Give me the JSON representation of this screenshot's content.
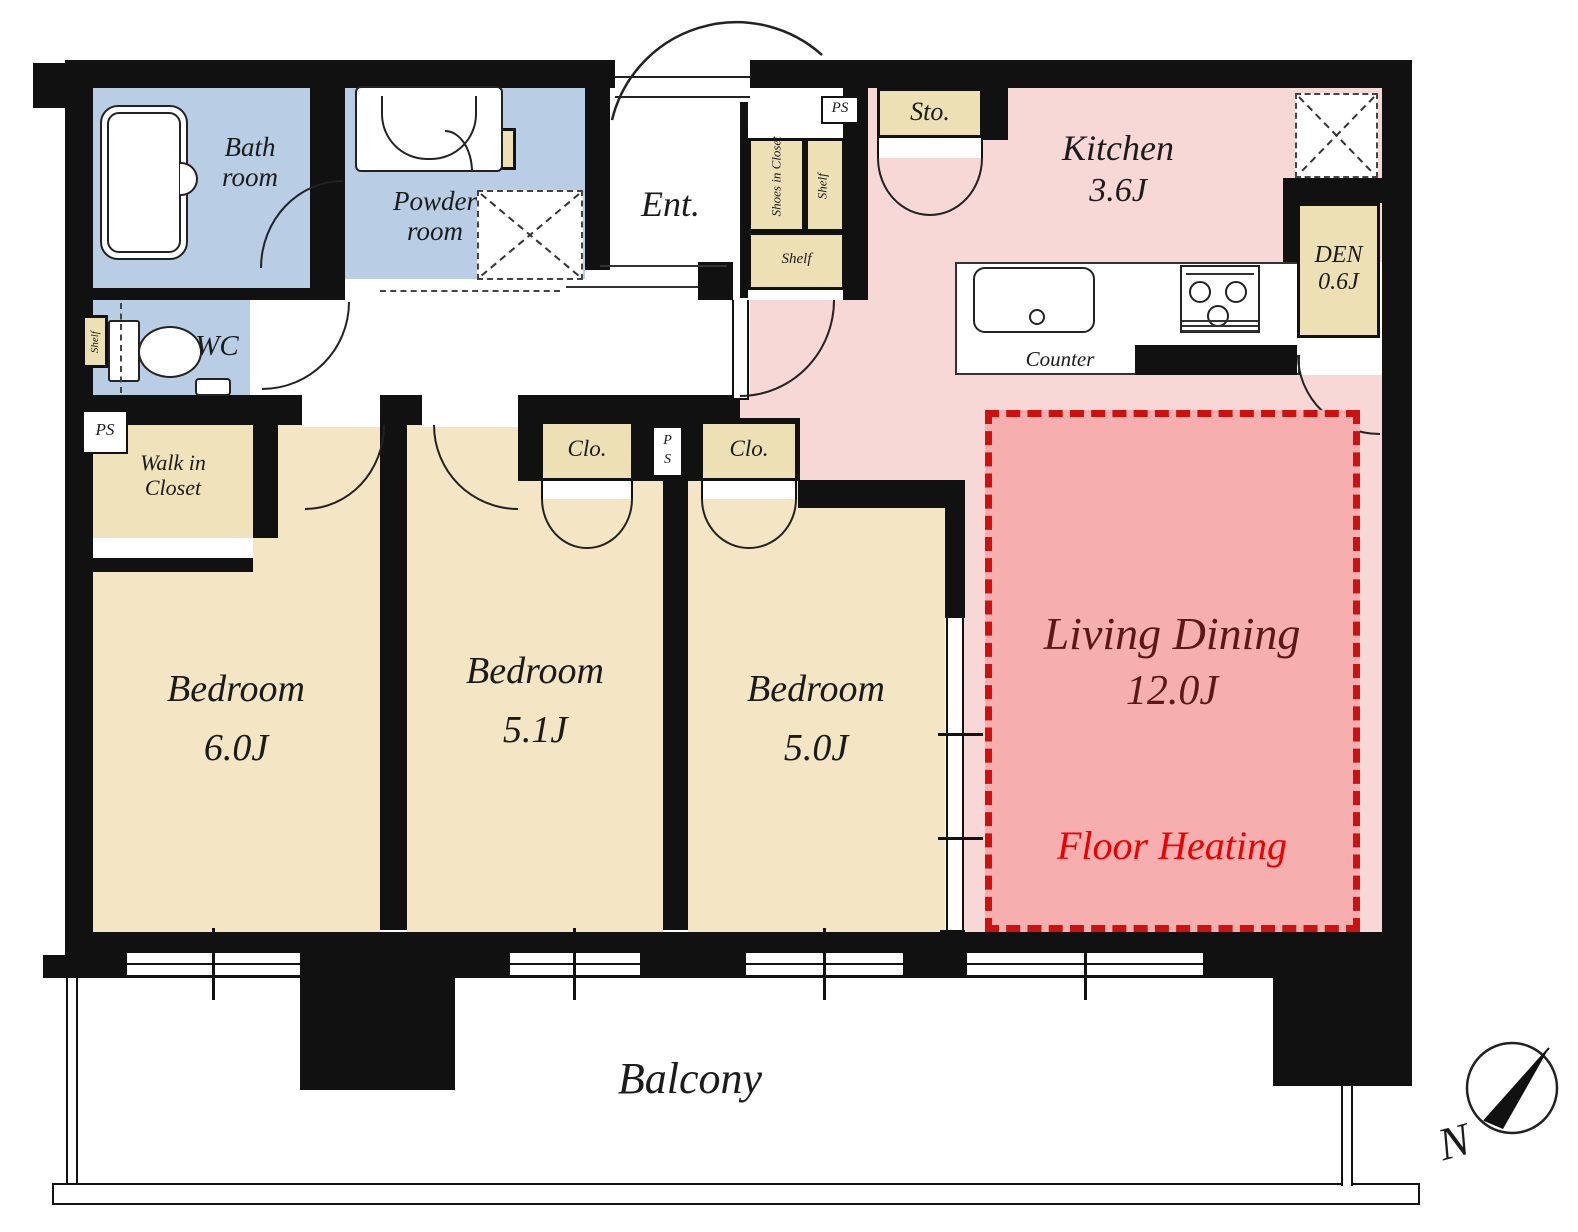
{
  "colors": {
    "wall": "#111111",
    "wet_area_blue": "#b9cde4",
    "room_beige": "#f4e6c4",
    "closet_beige": "#eee0b5",
    "kitchen_pink": "#f8d7d7",
    "floor_heating_pink": "#f6aeae",
    "floor_heating_dash_red": "#cc1111",
    "living_dining_text": "#5a1818",
    "floor_heating_text": "#ee0000"
  },
  "rooms": {
    "bath": {
      "name_line1": "Bath",
      "name_line2": "room"
    },
    "powder": {
      "name_line1": "Powder",
      "name_line2": "room"
    },
    "wc": {
      "name": "WC"
    },
    "entrance": {
      "name": "Ent."
    },
    "storage": {
      "name": "Sto."
    },
    "kitchen": {
      "name": "Kitchen",
      "size": "3.6J"
    },
    "den": {
      "name": "DEN",
      "size": "0.6J"
    },
    "counter": {
      "name": "Counter"
    },
    "walk_in_closet": {
      "name_line1": "Walk in",
      "name_line2": "Closet"
    },
    "bedroom1": {
      "name": "Bedroom",
      "size": "6.0J"
    },
    "bedroom2": {
      "name": "Bedroom",
      "size": "5.1J"
    },
    "bedroom3": {
      "name": "Bedroom",
      "size": "5.0J"
    },
    "living_dining": {
      "name": "Living Dining",
      "size": "12.0J",
      "floor_heating": "Floor Heating"
    },
    "balcony": {
      "name": "Balcony"
    }
  },
  "labels": {
    "lin": "Lin",
    "shelf": "Shelf",
    "shoes_in_closet": "Shoes in Closet",
    "closet_abbr": "Clo.",
    "pipe_space": "PS",
    "pipe_space_p": "P",
    "pipe_space_s": "S",
    "compass_north": "N"
  }
}
